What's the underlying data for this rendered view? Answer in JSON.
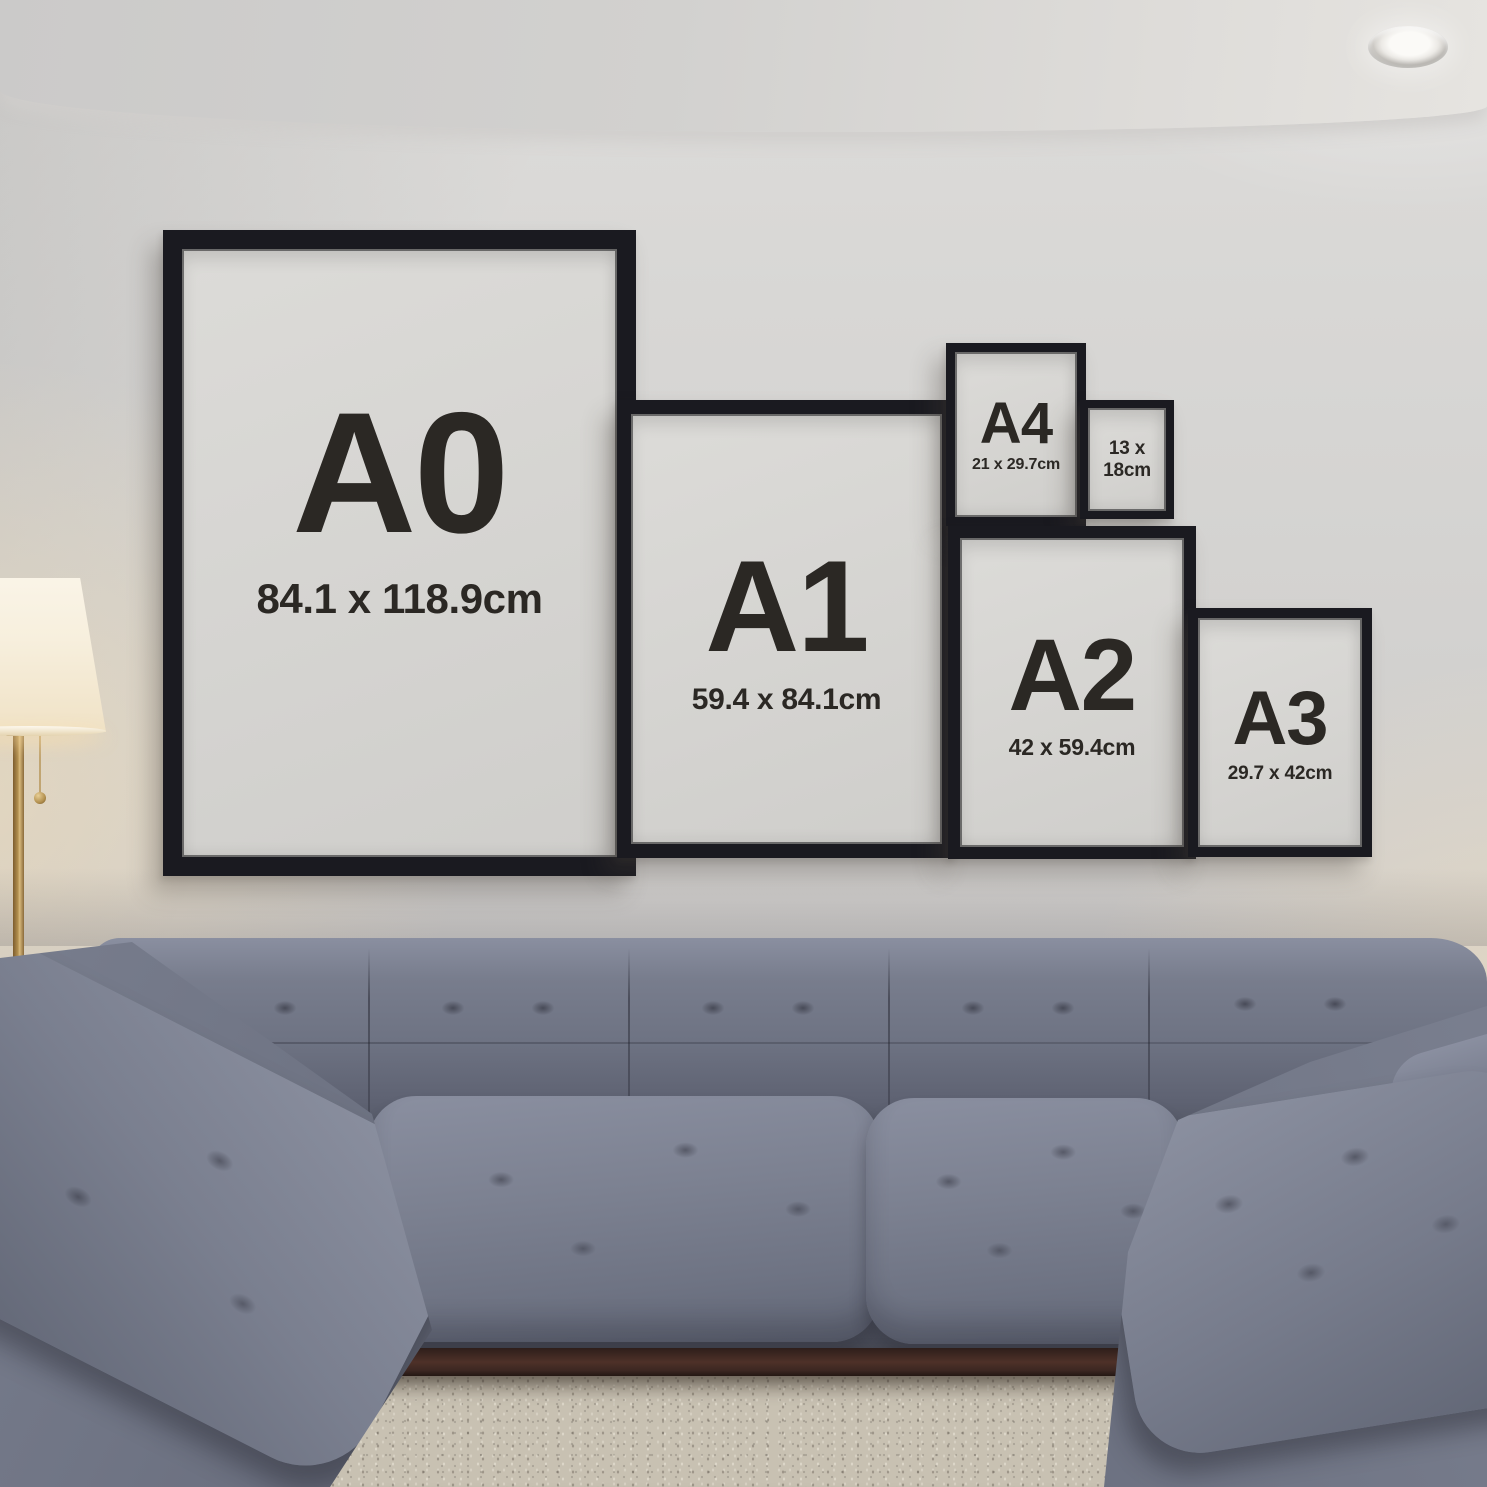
{
  "frames": {
    "a0": {
      "label": "A0",
      "dimensions": "84.1 x 118.9cm"
    },
    "a1": {
      "label": "A1",
      "dimensions": "59.4 x 84.1cm"
    },
    "a2": {
      "label": "A2",
      "dimensions": "42 x 59.4cm"
    },
    "a3": {
      "label": "A3",
      "dimensions": "29.7 x 42cm"
    },
    "a4": {
      "label": "A4",
      "dimensions": "21 x 29.7cm"
    },
    "size_13x18": {
      "line1": "13 x",
      "line2": "18cm"
    }
  },
  "colors": {
    "frame_black": "#1a1a20",
    "paper_light": "#dcdbd8",
    "paper_dark": "#cfcecb",
    "ink": "#2b2824",
    "wall_top": "#d8d7d5",
    "wall_bottom": "#cbc9c7",
    "ceiling_right": "#e6e4e0",
    "warm_glow": "#f6e3c0",
    "sofa_light": "#8a8fa0",
    "sofa_mid": "#6e7383",
    "sofa_dark": "#565a68",
    "sofa_deep": "#434653",
    "wood": "#3c2722",
    "rug_base": "#c8c1b2",
    "lamp_shade": "#f7efdd",
    "lamp_gold": "#b3904f",
    "downlight": "#fbfaf7"
  }
}
